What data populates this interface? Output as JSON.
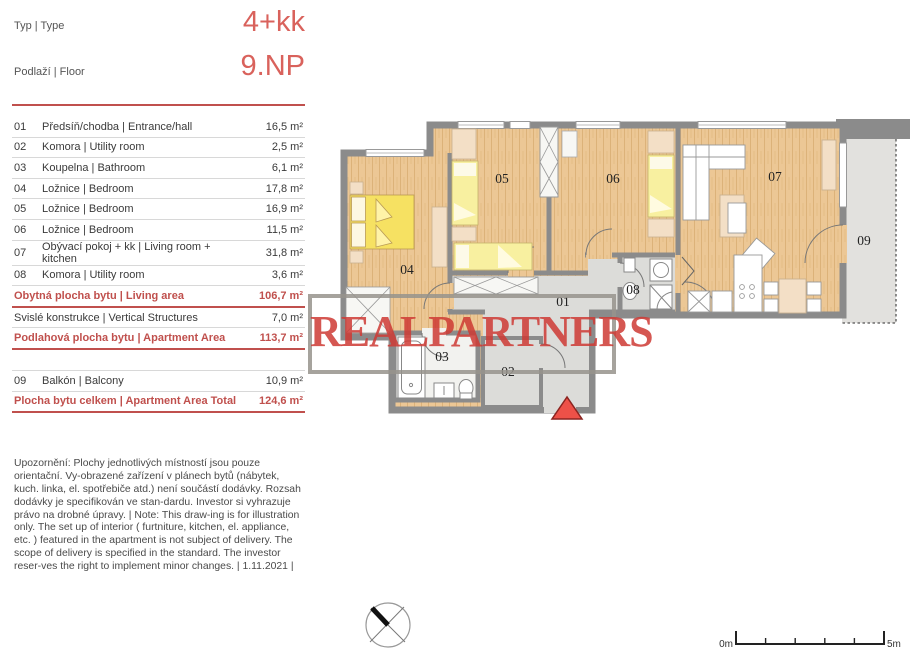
{
  "header": {
    "type_label": "Typ | Type",
    "type_value": "4+kk",
    "floor_label": "Podlaží | Floor",
    "floor_value": "9.NP"
  },
  "rooms": [
    {
      "num": "01",
      "name": "Předsíň/chodba | Entrance/hall",
      "area": "16,5 m²"
    },
    {
      "num": "02",
      "name": "Komora | Utility room",
      "area": "2,5 m²"
    },
    {
      "num": "03",
      "name": "Koupelna | Bathroom",
      "area": "6,1 m²"
    },
    {
      "num": "04",
      "name": "Ložnice | Bedroom",
      "area": "17,8 m²"
    },
    {
      "num": "05",
      "name": "Ložnice | Bedroom",
      "area": "16,9 m²"
    },
    {
      "num": "06",
      "name": "Ložnice | Bedroom",
      "area": "11,5 m²"
    },
    {
      "num": "07",
      "name": "Obývací pokoj + kk | Living room + kitchen",
      "area": "31,8 m²"
    },
    {
      "num": "08",
      "name": "Komora | Utility room",
      "area": "3,6 m²"
    }
  ],
  "summary": [
    {
      "label": "Obytná plocha bytu | Living area",
      "area": "106,7 m²"
    },
    {
      "label": "Svislé konstrukce | Vertical Structures",
      "area": "7,0 m²"
    },
    {
      "label": "Podlahová plocha bytu | Apartment Area",
      "area": "113,7 m²"
    }
  ],
  "balcony_row": {
    "num": "09",
    "name": "Balkón | Balcony",
    "area": "10,9 m²"
  },
  "total_row": {
    "label": "Plocha bytu celkem | Apartment Area Total",
    "area": "124,6 m²"
  },
  "disclaimer": "Upozornění: Plochy jednotlivých místností jsou pouze orientační. Vy-obrazené zařízení v plánech bytů (nábytek, kuch. linka, el. spotřebiče atd.) není součástí dodávky. Rozsah dodávky je specifikován ve stan-dardu. Investor si vyhrazuje právo na drobné úpravy. | Note: This draw-ing is for illustration only. The set up of interior ( furtniture, kitchen, el. appliance, etc. ) featured in the apartment is not subject of delivery. The scope of delivery is specified in the standard. The investor reser-ves the right to implement minor changes. | 1.11.2021 |",
  "watermark": "REALPARTNERS",
  "plan_labels": {
    "r01": "01",
    "r02": "02",
    "r03": "03",
    "r04": "04",
    "r05": "05",
    "r06": "06",
    "r07": "07",
    "r08": "08",
    "r09": "09"
  },
  "scalebar": {
    "start": "0m",
    "end": "5m"
  },
  "colors": {
    "accent_value": "#d9625c",
    "accent_table": "#c0504d",
    "watermark_red": "#ce3a34",
    "wall_gray": "#8b8b8b",
    "wood_floor": "#ecc795",
    "hall_gray": "#dcdcd9",
    "bed_yellow": "#f6e162",
    "bed_pale_yellow": "#f8f0a0",
    "furniture_beige": "#f3dfc6",
    "entrance_triangle": "#ed5148"
  }
}
